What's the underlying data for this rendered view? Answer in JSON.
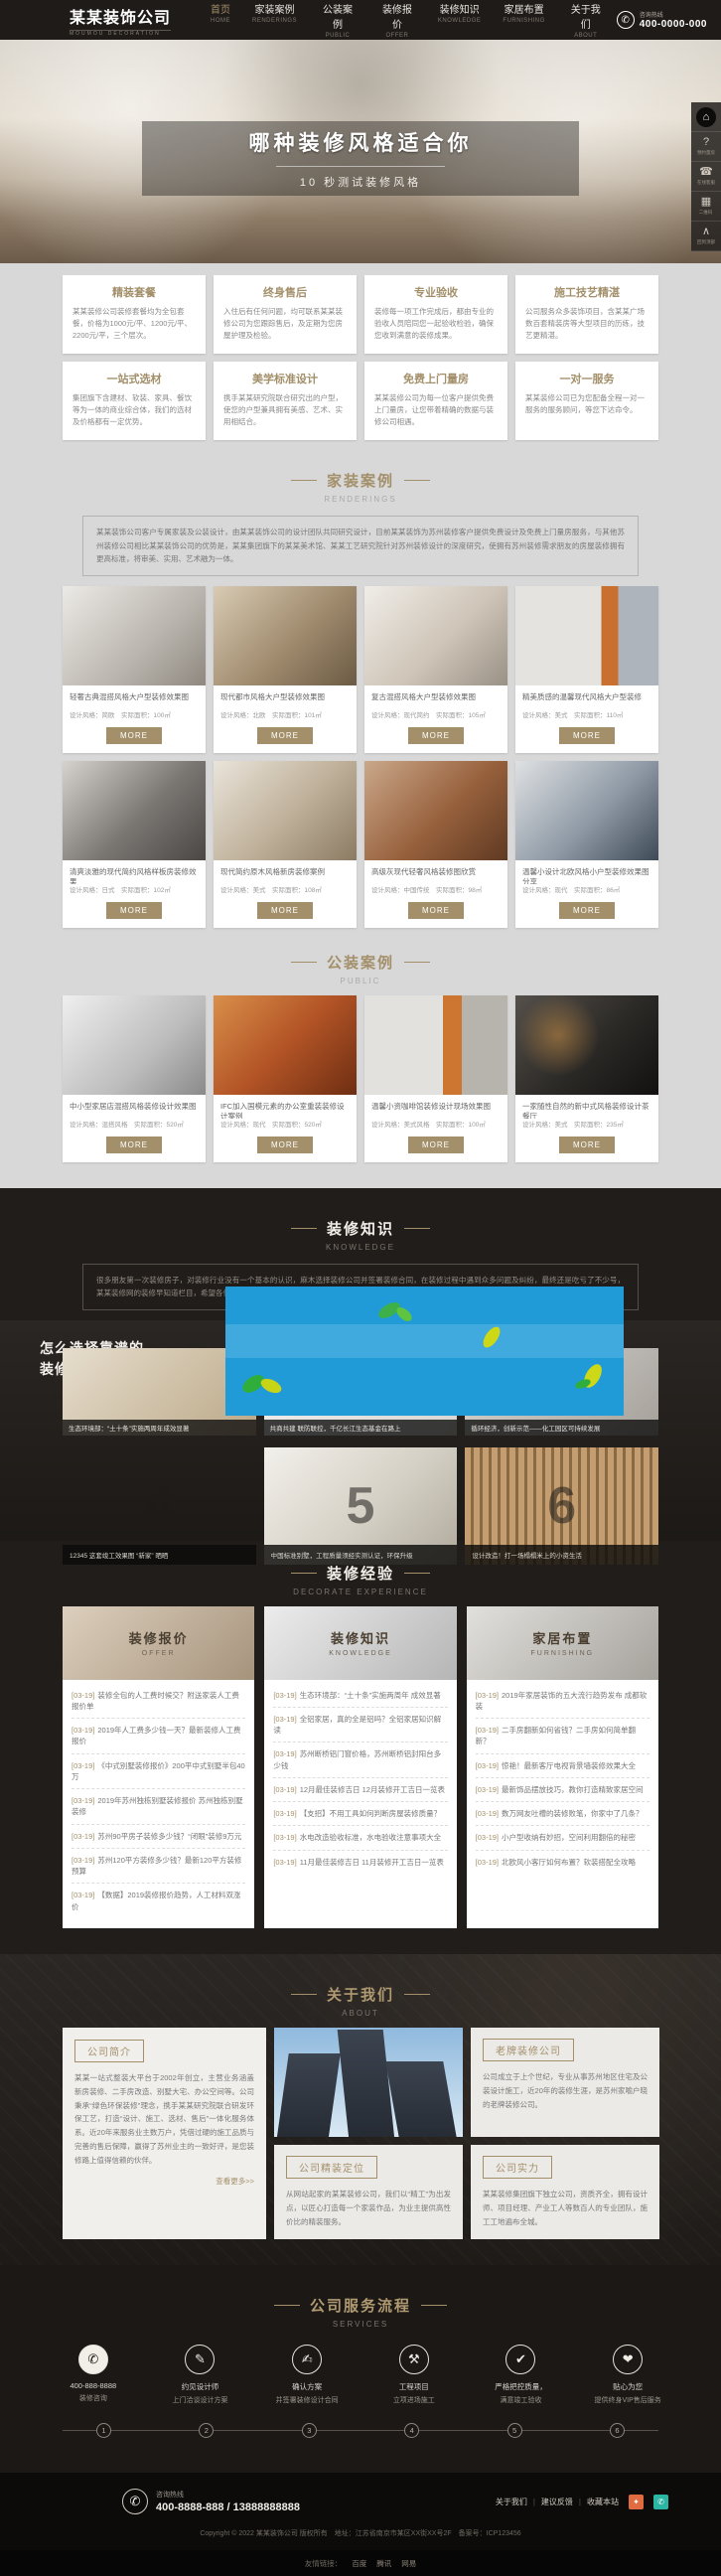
{
  "labels": {
    "more": "MORE"
  },
  "header": {
    "logo": "某某装饰公司",
    "logo_sub": "MOUMOU DECORATION",
    "nav": [
      {
        "zh": "首页",
        "en": "HOME"
      },
      {
        "zh": "家装案例",
        "en": "RENDERINGS"
      },
      {
        "zh": "公装案例",
        "en": "PUBLIC"
      },
      {
        "zh": "装修报价",
        "en": "OFFER"
      },
      {
        "zh": "装修知识",
        "en": "KNOWLEDGE"
      },
      {
        "zh": "家居布置",
        "en": "FURNISHING"
      },
      {
        "zh": "关于我们",
        "en": "ABOUT"
      }
    ],
    "hotline_label": "咨询热线",
    "hotline": "400-0000-000"
  },
  "banner": {
    "title": "哪种装修风格适合你",
    "subtitle": "10 秒测试装修风格"
  },
  "rail": {
    "items": [
      "",
      "预约量房",
      "在线客服",
      "二维码",
      "回到顶部"
    ]
  },
  "features": [
    {
      "title": "精装套餐",
      "text": "某某装修公司装修套餐均为全包套餐，价格为1000元/平、1200元/平、2200元/平，三个层次。"
    },
    {
      "title": "终身售后",
      "text": "入住后有任何问题，均可联系某某装修公司为您跟踪售后，及定期为您房屋护理及检验。"
    },
    {
      "title": "专业验收",
      "text": "装修每一项工作完成后，都由专业的验收人员陪同您一起验收检验，确保您收到满意的装修成果。"
    },
    {
      "title": "施工技艺精湛",
      "text": "公司服务众多装饰项目，含某某广场数百套精装房等大型项目的历练，技艺更精湛。"
    },
    {
      "title": "一站式选材",
      "text": "集团旗下含建材、软装、家具、餐饮等为一体的商业综合体，我们的选材及价格都有一定优势。"
    },
    {
      "title": "美学标准设计",
      "text": "携手某某研究院联合研究出的户型，使您的户型兼具拥有美感、艺术、实用相结合。"
    },
    {
      "title": "免费上门量房",
      "text": "某某装修公司为每一位客户提供免费上门量房，让您带着精确的数据与装修公司相遇。"
    },
    {
      "title": "一对一服务",
      "text": "某某装修公司已为您配备全程一对一服务的服务顾问，等您下达命令。"
    }
  ],
  "sections": {
    "renderings": {
      "zh": "家装案例",
      "en": "RENDERINGS"
    },
    "public": {
      "zh": "公装案例",
      "en": "PUBLIC"
    },
    "knowledge": {
      "zh": "装修知识",
      "en": "KNOWLEDGE"
    },
    "experience": {
      "zh": "装修经验",
      "en": "DECORATE EXPERIENCE"
    },
    "about": {
      "zh": "关于我们",
      "en": "ABOUT"
    },
    "services": {
      "zh": "公司服务流程",
      "en": "SERVICES"
    }
  },
  "renderings": {
    "intro": "某某装饰公司客户专属家装及公装设计，由某某装饰公司的设计团队共同研究设计，目前某某装饰为苏州装修客户提供免费设计及免费上门量房服务，与其他苏州装修公司相比某某装饰公司的优势是，某某集团旗下的某某美术馆、某某工艺研究院针对苏州装修设计的深度研究，使拥有苏州装修需求朋友的房屋装修拥有更高标准，将审美、实用、艺术融为一体。",
    "cards": [
      {
        "title": "轻奢古典混搭风格大户型装修效果图",
        "meta": "设计风格：简欧　实际面积：100㎡"
      },
      {
        "title": "现代都市风格大户型装修效果图",
        "meta": "设计风格：北欧　实际面积：101㎡"
      },
      {
        "title": "复古混搭风格大户型装修效果图",
        "meta": "设计风格：现代简约　实际面积：105㎡"
      },
      {
        "title": "精美质感的温馨现代风格大户型装修",
        "meta": "设计风格：美式　实际面积：110㎡"
      },
      {
        "title": "清爽淡雅的现代简约风格样板房装修效果",
        "meta": "设计风格：日式　实际面积：102㎡"
      },
      {
        "title": "现代简约原木风格新房装修案例",
        "meta": "设计风格：美式　实际面积：108㎡"
      },
      {
        "title": "高级灰现代轻奢风格装修图欣赏",
        "meta": "设计风格：中国传统　实际面积：98㎡"
      },
      {
        "title": "温馨小设计北欧风格小户型装修效果图分享",
        "meta": "设计风格：现代　实际面积：86㎡"
      }
    ]
  },
  "public_cases": {
    "cards": [
      {
        "title": "中小型家居店混搭风格装修设计效果图",
        "meta": "设计风格：混搭风格　实际面积：520㎡"
      },
      {
        "title": "IFC加入国模元素的办公室重装装修设计案例",
        "meta": "设计风格：现代　实际面积：520㎡"
      },
      {
        "title": "温馨小资咖啡馆装修设计现场效果图",
        "meta": "设计风格：美式风格　实际面积：100㎡"
      },
      {
        "title": "一家随性自然的新中式风格装修设计茶餐厅",
        "meta": "设计风格：美式　实际面积：235㎡"
      }
    ]
  },
  "knowledge": {
    "intro": "很多朋友第一次装修房子，对装修行业没有一个基本的认识，麻木选择装修公司并签署装修合同，在装修过程中遇到众多问题及纠纷，最终还是吃亏了不少号，某某装修网的装修早知道栏目，希望各位朋友在装修前都先了解一下，最终能与优质的装修公司一起打造出自己美美的房子。",
    "banner_line1": "怎么选择靠谱的",
    "banner_line2": "装修公司?",
    "news": [
      "生态环境部：“土十条”实施两周年成效显著",
      "共商共建 联防联控，千亿长江生态基金在路上",
      "循环经济，创新示范——化工园区可持续发展"
    ],
    "slides": [
      {
        "num": "4",
        "caption": "12345 这套竣工效果图 “新家” 晒晒"
      },
      {
        "num": "5",
        "caption": "中国标准别墅，工程质量须经实测认证，环保升级"
      },
      {
        "num": "6",
        "caption": "设计改造！打一场榻榻米上的小资生活"
      }
    ]
  },
  "experience": {
    "columns": [
      {
        "zh": "装修报价",
        "en": "OFFER",
        "items": [
          {
            "date": "[03-19]",
            "title": "装修全包的人工费时候交？附送家装人工费报价单"
          },
          {
            "date": "[03-19]",
            "title": "2019年人工费多少钱一天？最新装修人工费报价"
          },
          {
            "date": "[03-19]",
            "title": "《中式别墅装修报价》200平中式别墅半包40万"
          },
          {
            "date": "[03-19]",
            "title": "2019年苏州独栋别墅装修报价 苏州独栋别墅装修"
          },
          {
            "date": "[03-19]",
            "title": "苏州90平房子装修多少钱？“闭眼”装修9万元"
          },
          {
            "date": "[03-19]",
            "title": "苏州120平方装修多少钱？最新120平方装修预算"
          },
          {
            "date": "[03-19]",
            "title": "【数据】2019装修报价趋势，人工材料双涨价"
          }
        ]
      },
      {
        "zh": "装修知识",
        "en": "KNOWLEDGE",
        "items": [
          {
            "date": "[03-19]",
            "title": "生态环境部：“土十条”实施两周年 成效显著"
          },
          {
            "date": "[03-19]",
            "title": "全铝家居，真的全是铝吗？全铝家居知识解读"
          },
          {
            "date": "[03-19]",
            "title": "苏州断桥铝门窗价格，苏州断桥铝封阳台多少钱"
          },
          {
            "date": "[03-19]",
            "title": "12月最佳装修吉日 12月装修开工吉日一览表"
          },
          {
            "date": "[03-19]",
            "title": "【支招】不用工具如何判断房屋装修质量？"
          },
          {
            "date": "[03-19]",
            "title": "水电改造验收标准，水电验收注意事项大全"
          },
          {
            "date": "[03-19]",
            "title": "11月最佳装修吉日 11月装修开工吉日一览表"
          }
        ]
      },
      {
        "zh": "家居布置",
        "en": "FURNISHING",
        "items": [
          {
            "date": "[03-19]",
            "title": "2019年家居装饰的五大流行趋势发布 成都软装"
          },
          {
            "date": "[03-19]",
            "title": "二手房翻新如何省钱？二手房如何简单翻新？"
          },
          {
            "date": "[03-19]",
            "title": "惊艳！最新客厅电视背景墙装修效果大全"
          },
          {
            "date": "[03-19]",
            "title": "最新饰品摆放技巧，教你打造精致家居空间"
          },
          {
            "date": "[03-19]",
            "title": "数万网友吐槽的装修败笔，你家中了几条？"
          },
          {
            "date": "[03-19]",
            "title": "小户型收纳有妙招，空间利用翻倍的秘密"
          },
          {
            "date": "[03-19]",
            "title": "北欧风小客厅如何布置？软装搭配全攻略"
          }
        ]
      }
    ]
  },
  "about": {
    "intro_label": "公司简介",
    "intro": "某某一站式整装大平台于2002年创立，主营业务涵盖新房装修、二手房改造、别墅大宅、办公空间等。公司秉承“绿色环保装修”理念，携手某某研究院联合研发环保工艺，打造“设计、施工、选材、售后”一体化服务体系。近20年来服务业主数万户，凭借过硬的施工品质与完善的售后保障，赢得了苏州业主的一致好评，是您装修路上值得信赖的伙伴。",
    "more": "查看更多>>",
    "cards": [
      {
        "label": "老牌装修公司",
        "text": "公司成立于上个世纪，专业从事苏州地区住宅及公装设计施工，近20年的装修生涯，是苏州家喻户晓的老牌装修公司。"
      },
      {
        "label": "公司精装定位",
        "text": "从网站起家的某某装修公司，我们以“精工”为出发点，以匠心打造每一个家装作品，为业主提供高性价比的精装服务。"
      },
      {
        "label": "公司实力",
        "text": "某某装修集团旗下独立公司，资质齐全，拥有设计师、项目经理、产业工人等数百人的专业团队，施工工地遍布全城。"
      }
    ]
  },
  "services": {
    "steps": [
      {
        "num": "1",
        "line1": "400-888-8888",
        "line2": "装修咨询"
      },
      {
        "num": "2",
        "line1": "约见设计师",
        "line2": "上门洽谈设计方案"
      },
      {
        "num": "3",
        "line1": "确认方案",
        "line2": "并签署装修设计合同"
      },
      {
        "num": "4",
        "line1": "工程项目",
        "line2": "立项进场施工"
      },
      {
        "num": "5",
        "line1": "严格把控质量，",
        "line2": "满意竣工验收"
      },
      {
        "num": "6",
        "line1": "贴心为您",
        "line2": "提供终身VIP售后服务"
      }
    ]
  },
  "footer": {
    "hotline_label": "咨询热线",
    "phone": "400-8888-888 / 13888888888",
    "links": [
      "关于我们",
      "建议反馈",
      "收藏本站"
    ],
    "copyright": "Copyright © 2022 某某装饰公司 版权所有　地址：江苏省南京市某区XX街XX号2F　备案号：ICP123456",
    "friends_label": "友情链接：",
    "friends": [
      "百度",
      "腾讯",
      "网易"
    ]
  },
  "colors": {
    "accent": "#a3906b",
    "dark_bg": "#211d1a",
    "video_blue": "#219bd8"
  }
}
